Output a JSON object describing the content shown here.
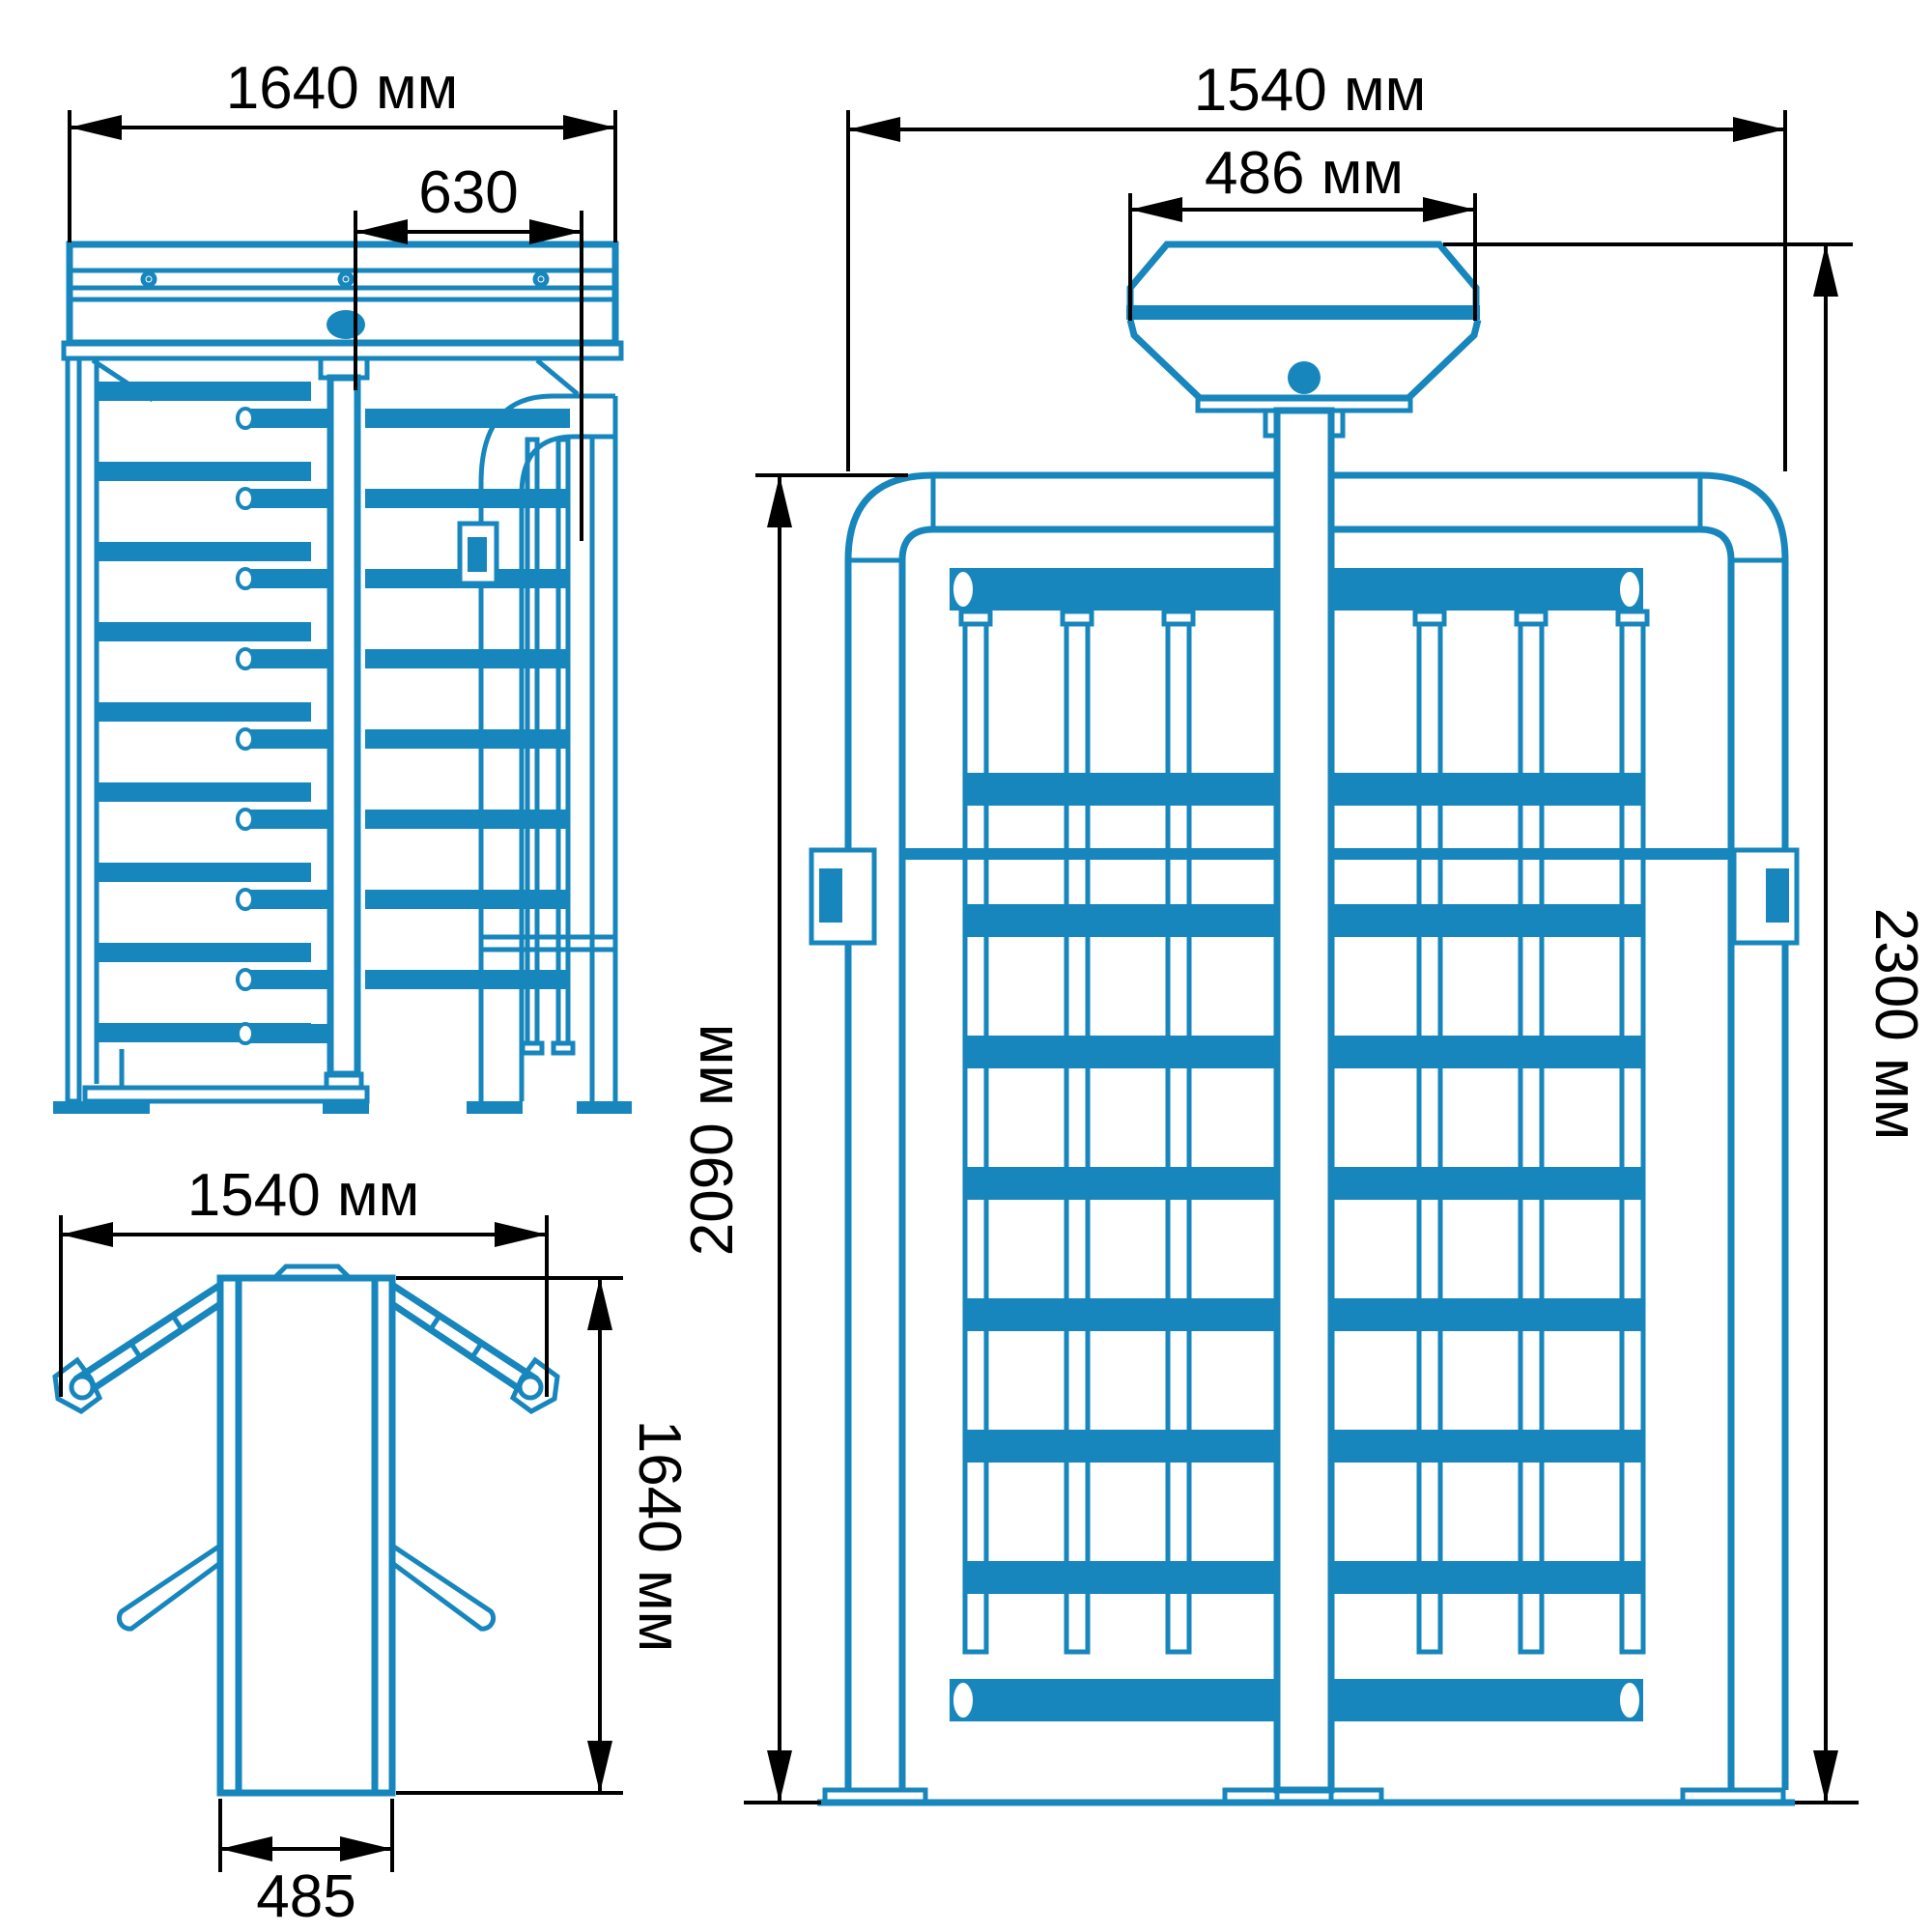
{
  "colors": {
    "drawing": "#1786bd",
    "dimension": "#000000",
    "background": "#ffffff"
  },
  "views": {
    "side": {
      "width_label": "1640 мм",
      "offset_label": "630"
    },
    "plan": {
      "width_label": "1540 мм",
      "depth_label": "1640 мм",
      "column_label": "485"
    },
    "front": {
      "width_label": "1540 мм",
      "canopy_label": "486 мм",
      "frame_height_label": "2090 мм",
      "total_height_label": "2300 мм"
    }
  }
}
